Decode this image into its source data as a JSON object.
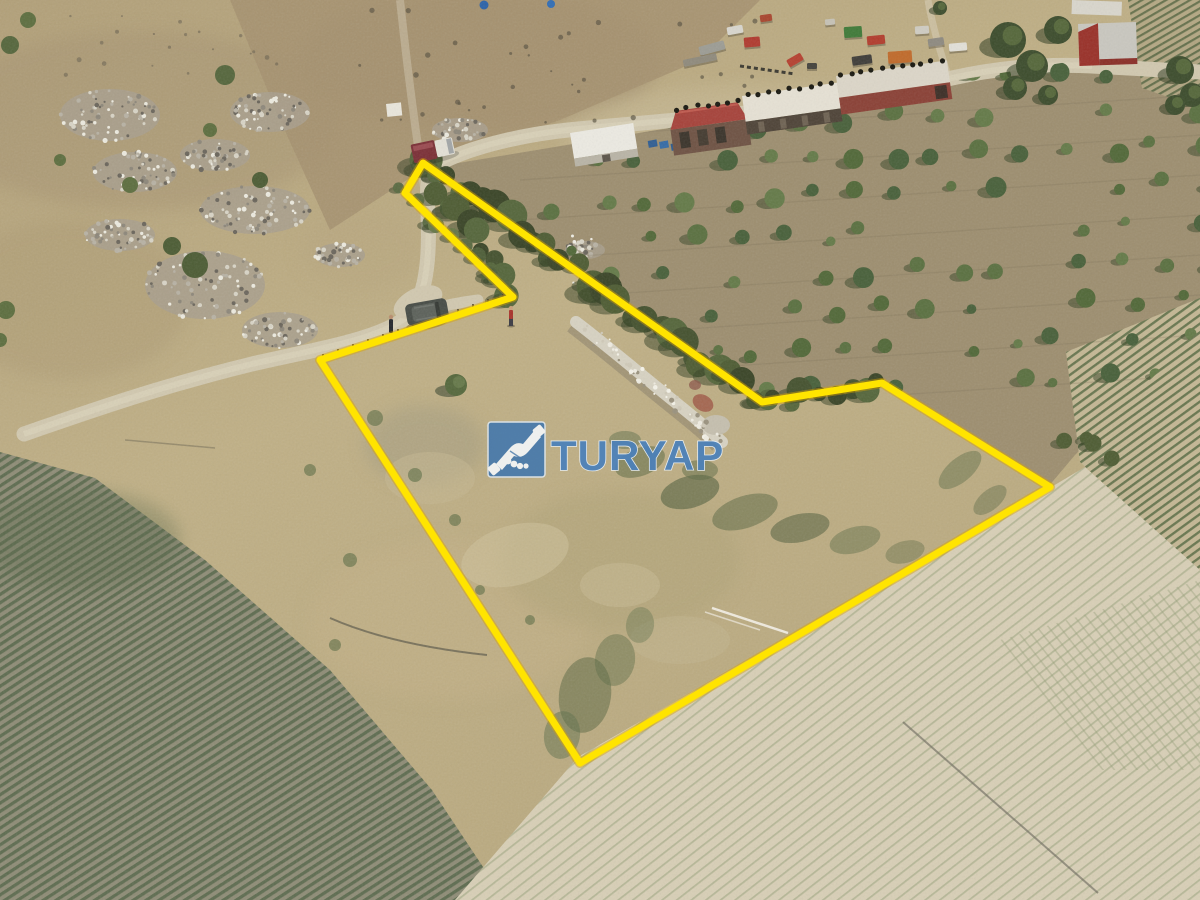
{
  "image_type": "aerial drone photograph of rural land parcel for sale",
  "watermark": {
    "brand": "TURYAP",
    "icon": "handshake-icon",
    "icon_bg_color": "#4176ae",
    "icon_glyph_color": "#f3f5f7",
    "text_color": "#4a80ba",
    "text_outline_color": "#e9f0f7"
  },
  "boundary": {
    "points": "423,163 762,402 882,383 1050,487 580,763 320,360 513,297 405,193",
    "color": "#ffe400",
    "halo_color": "#d9a400",
    "stroke_width": 7
  },
  "palette": {
    "dry_grass": "#bdac82",
    "upper_slope": "#a5906f",
    "orchard_soil": "#9d8e6f",
    "green_field_row": "#5e6c50",
    "green_field_gap": "#8e8c76",
    "pale_field": "#d8cfb6",
    "road": "#d1c8af",
    "rock_pile": "#a89f8d",
    "tree_canopy": "#4c5c34",
    "stone_wall": "#d7d2c2",
    "suv_color": "#474c46",
    "red_roof": "#a6423a"
  }
}
